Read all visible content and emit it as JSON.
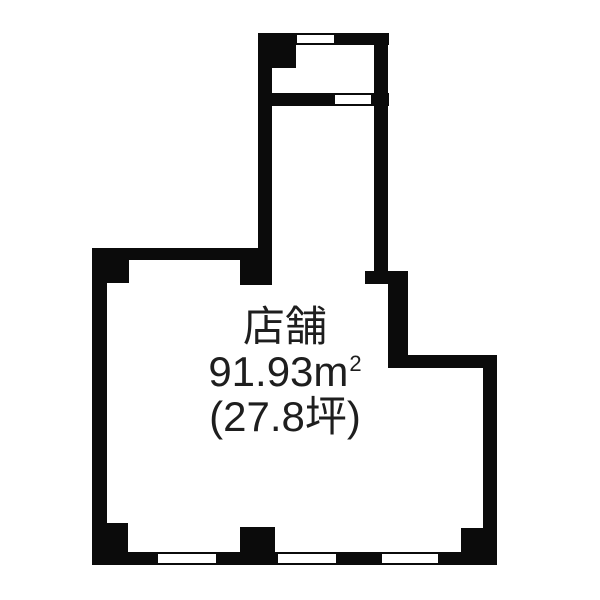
{
  "floorplan": {
    "room": {
      "label": "店舗",
      "area_value": "91.93",
      "area_unit_base": "m",
      "area_unit_exponent": "2",
      "area_display": "91.93㎡",
      "tsubo_display": "(27.8坪)"
    },
    "colors": {
      "wall": "#0b0b0b",
      "background": "#ffffff",
      "text": "#1e1e1e"
    }
  }
}
